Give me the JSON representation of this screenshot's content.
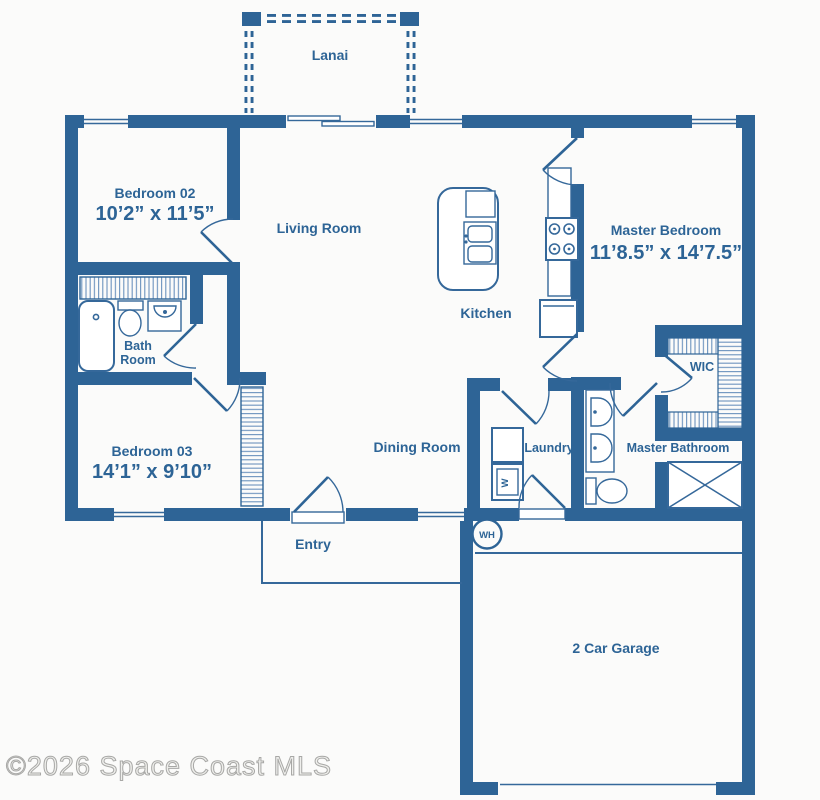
{
  "plan": {
    "watermark": "©2026 Space Coast MLS",
    "colors": {
      "wall": "#2e6496",
      "label_text": "#2d6496",
      "background": "#fbfbfa",
      "watermark_gray": "#a8a8a6"
    },
    "rooms": {
      "lanai": {
        "name": "Lanai"
      },
      "bedroom02": {
        "name": "Bedroom 02",
        "dimensions": "10’2” x 11’5”"
      },
      "living": {
        "name": "Living Room"
      },
      "master_bedroom": {
        "name": "Master Bedroom",
        "dimensions": "11’8.5” x 14’7.5”"
      },
      "kitchen": {
        "name": "Kitchen"
      },
      "bath": {
        "name_line1": "Bath",
        "name_line2": "Room"
      },
      "bedroom03": {
        "name": "Bedroom 03",
        "dimensions": "14’1” x 9’10”"
      },
      "dining": {
        "name": "Dining Room"
      },
      "laundry": {
        "name": "Laundry"
      },
      "master_bath": {
        "name": "Master Bathroom"
      },
      "wic": {
        "name": "WIC"
      },
      "entry": {
        "name": "Entry"
      },
      "garage": {
        "name": "2 Car Garage"
      }
    },
    "fixtures": {
      "water_heater": "WH",
      "washer": "W"
    }
  }
}
